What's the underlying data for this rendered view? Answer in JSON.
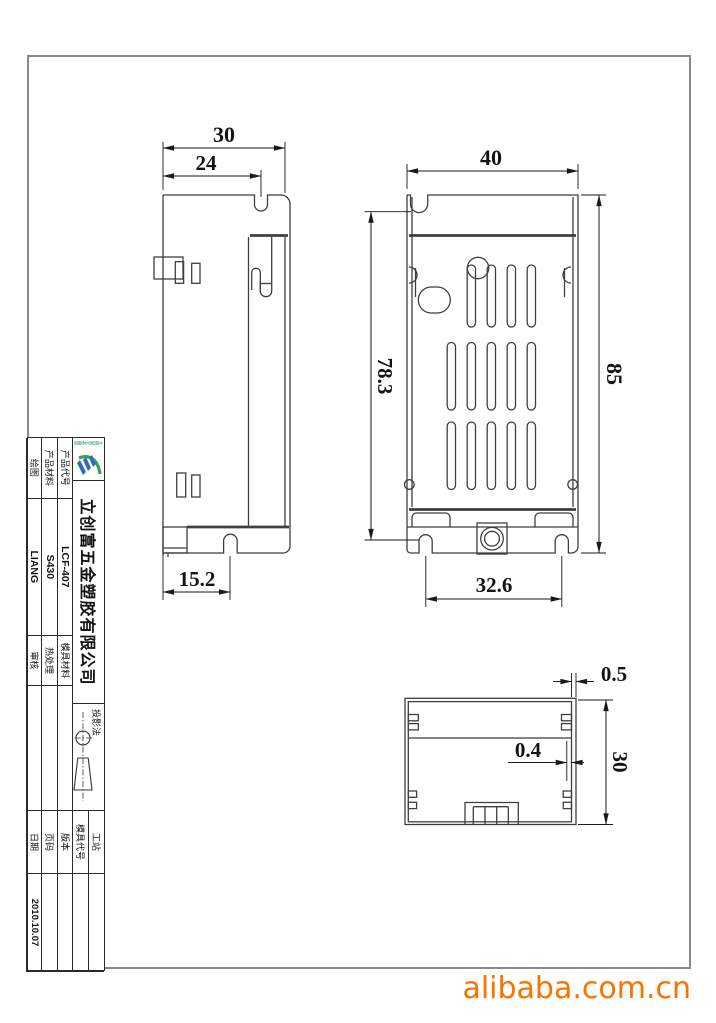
{
  "page": {
    "bg": "#ffffff",
    "frame_color": "#8a8a8a",
    "line_color": "#3f3f3f",
    "accent": "#f97300"
  },
  "watermark": {
    "text": "alibaba.com.cn",
    "color": "#f97300"
  },
  "dimensions": {
    "side_top_width": "30",
    "side_notch_width": "24",
    "side_bottom": "15.2",
    "front_top_width": "40",
    "front_left_height": "78.3",
    "front_right_height": "85",
    "front_bottom_span": "32.6",
    "top_wall": "0.5",
    "top_inner_wall": "0.4",
    "top_depth": "30"
  },
  "title_block": {
    "company_name": "立创富五金塑胶有限公司",
    "logo_caption": "立创富五金塑胶",
    "projection_label": "投影法",
    "station_label": "工站",
    "station_value": "",
    "mold_code_label": "模具代号",
    "mold_code_value": "",
    "rows": [
      {
        "label1": "产品代号",
        "value1": "LCF-407",
        "label2": "模具材料",
        "value2": "",
        "label3": "版本",
        "value3": ""
      },
      {
        "label1": "产品材料",
        "value1": "S430",
        "label2": "热处理",
        "value2": "",
        "label3": "页码",
        "value3": ""
      },
      {
        "label1": "绘图",
        "value1": "LIANG",
        "label2": "审核",
        "value2": "",
        "label3": "日期",
        "value3": "2010.10.07"
      }
    ]
  }
}
